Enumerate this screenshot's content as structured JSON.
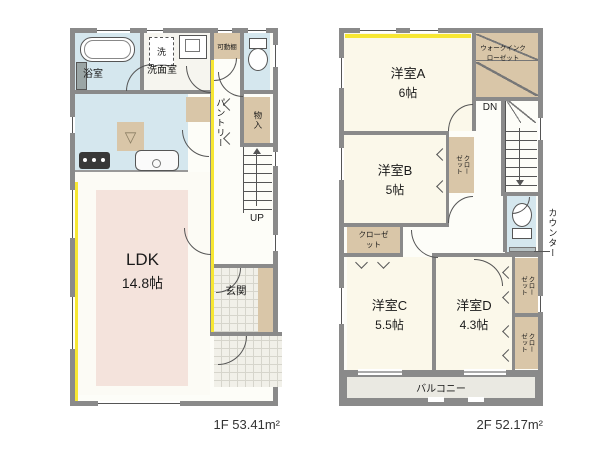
{
  "colors": {
    "wall": "#8a8a8a",
    "water_room_blue": "#d5e7ee",
    "closet_tan": "#d9c6a8",
    "room_cream": "#fbf8ea",
    "ldk_rug_pink": "#f4e3dc",
    "highlight_yellow": "#f7e733",
    "tile_gray": "#f1f0e9",
    "balcony_gray": "#eae9e2"
  },
  "icons": {
    "fridge_space": "▽"
  },
  "floor1": {
    "area_label": "1F 53.41m²",
    "rooms": {
      "bathroom": {
        "label": "浴室"
      },
      "washroom": {
        "label": "洗面室"
      },
      "washer": {
        "label": "洗"
      },
      "movable_shelf": {
        "label": "可動棚"
      },
      "pantry": {
        "label": "パントリー"
      },
      "storage": {
        "label": "物入"
      },
      "stairs": {
        "label": "UP"
      },
      "ldk": {
        "label": "LDK",
        "size": "14.8帖"
      },
      "entrance": {
        "label": "玄関"
      }
    }
  },
  "floor2": {
    "area_label": "2F 52.17m²",
    "rooms": {
      "room_a": {
        "label": "洋室A",
        "size": "6帖"
      },
      "walk_in_closet": {
        "label": "ウォークインクローゼット"
      },
      "stairs": {
        "label": "DN"
      },
      "room_b": {
        "label": "洋室B",
        "size": "5帖"
      },
      "closet_b": {
        "label": "クローゼット"
      },
      "closet_hall": {
        "label": "クローゼット"
      },
      "room_c": {
        "label": "洋室C",
        "size": "5.5帖"
      },
      "room_d": {
        "label": "洋室D",
        "size": "4.3帖"
      },
      "closet_d_upper": {
        "label": "クローゼット"
      },
      "closet_d_lower": {
        "label": "クローゼット"
      },
      "counter": {
        "label": "カウンター"
      },
      "balcony": {
        "label": "バルコニー"
      }
    }
  }
}
